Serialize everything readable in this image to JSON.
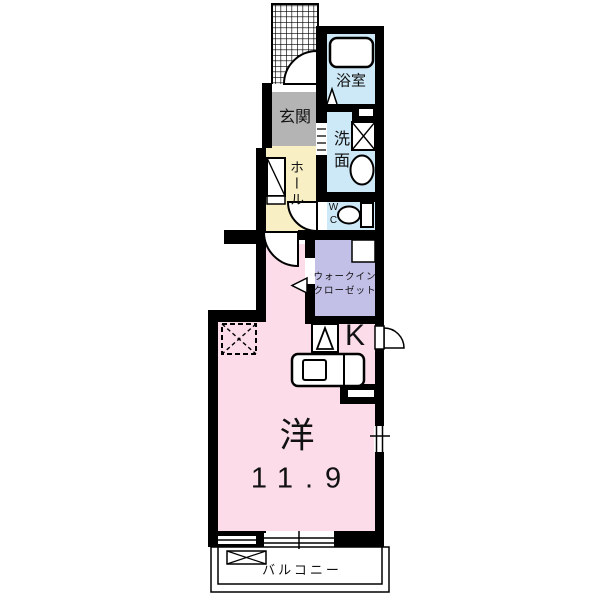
{
  "floorplan": {
    "labels": {
      "genkan": "玄関",
      "hall": "ホール",
      "bathroom": "浴室",
      "washroom": "洗面",
      "wc": "WC",
      "closet_line1": "ウォークイン",
      "closet_line2": "クローゼット",
      "kitchen": "K",
      "room_type": "洋",
      "room_size": "11.9",
      "balcony": "バルコニー"
    },
    "colors": {
      "wall": "#000000",
      "genkan_floor": "#b4b4b4",
      "hall_floor": "#f8efc5",
      "wet_area_floor": "#cde8f6",
      "closet_floor": "#c3c0e8",
      "room_floor": "#fbdce8",
      "fixture": "#ffffff"
    }
  }
}
